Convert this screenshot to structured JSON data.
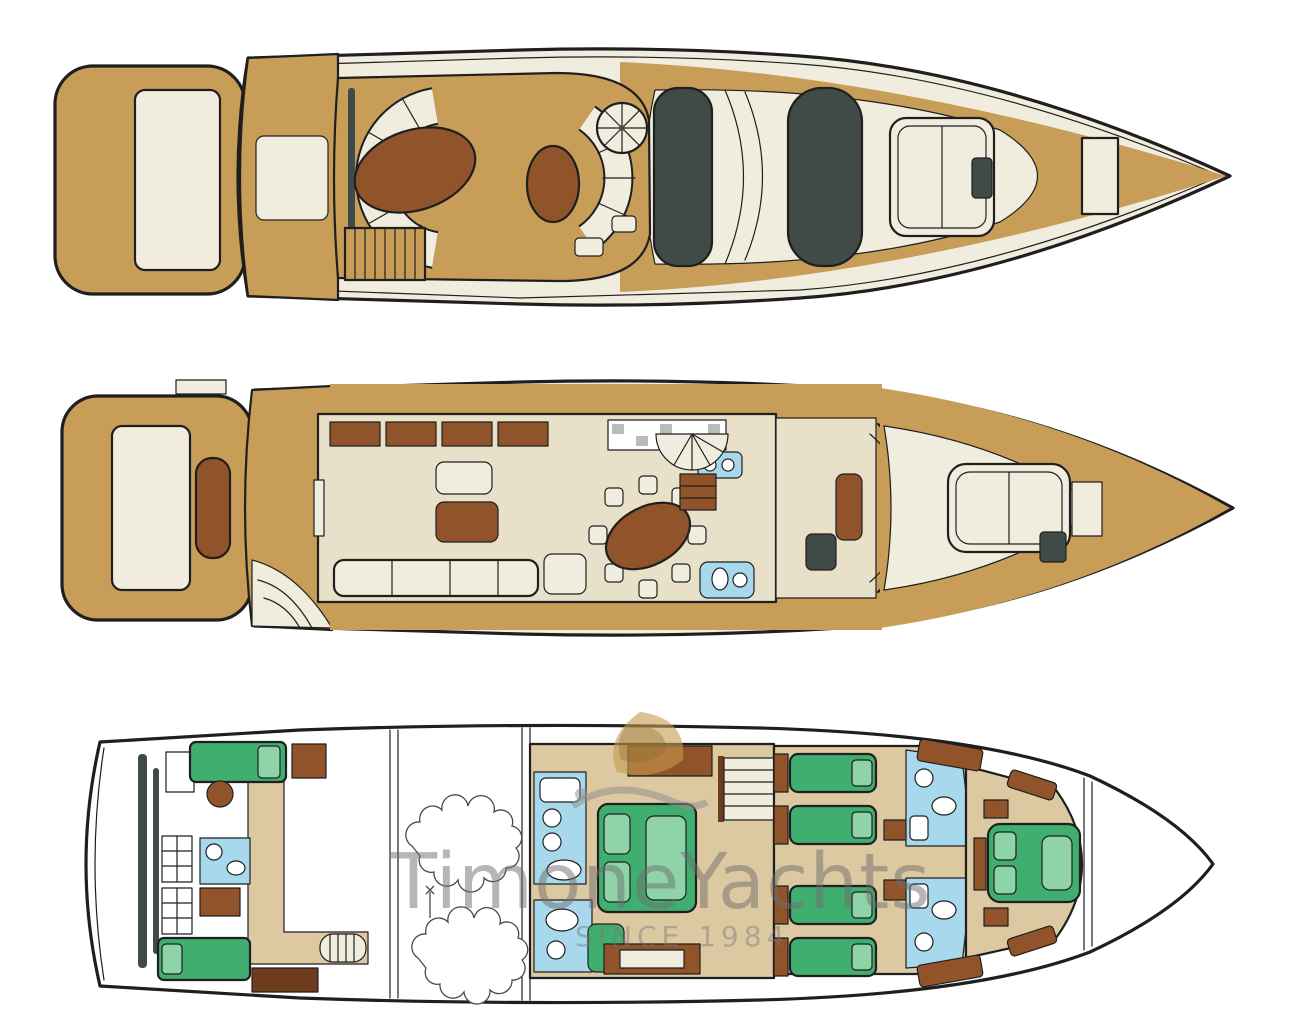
{
  "figure": {
    "kind": "yacht-deck-plan",
    "description": "Three stacked top-view deck plans of a motor yacht, bow pointing right"
  },
  "watermark": {
    "brand": "TimoneYachts",
    "tagline": "SINCE 1984",
    "logo_icon": "sail-and-wave-emblem"
  },
  "decks": [
    {
      "id": "flybridge",
      "label": "Flybridge sun deck with C-shaped settee, bar, spiral stair, hardtop and bow sunpad"
    },
    {
      "id": "main-deck",
      "label": "Main deck with aft platform, salon sofas, dining table for eight, galley, helm and bow sunpad"
    },
    {
      "id": "lower-deck",
      "label": "Lower deck with crew quarters, engine room, master cabin, twin guest cabins, bathrooms and VIP bow cabin"
    }
  ],
  "colors": {
    "bg": "#ffffff",
    "ln": "#1f1f1f",
    "teak": "#c79d58",
    "cream": "#f1edde",
    "beige": "#dcc9a1",
    "beige2": "#e9e0c9",
    "wood": "#91532a",
    "wood2": "#6e3b1c",
    "charcoal": "#404a47",
    "green": "#3fae6e",
    "green2": "#8ed4a8",
    "blue": "#a8d8ec",
    "wmtan": "#c49a4e"
  }
}
